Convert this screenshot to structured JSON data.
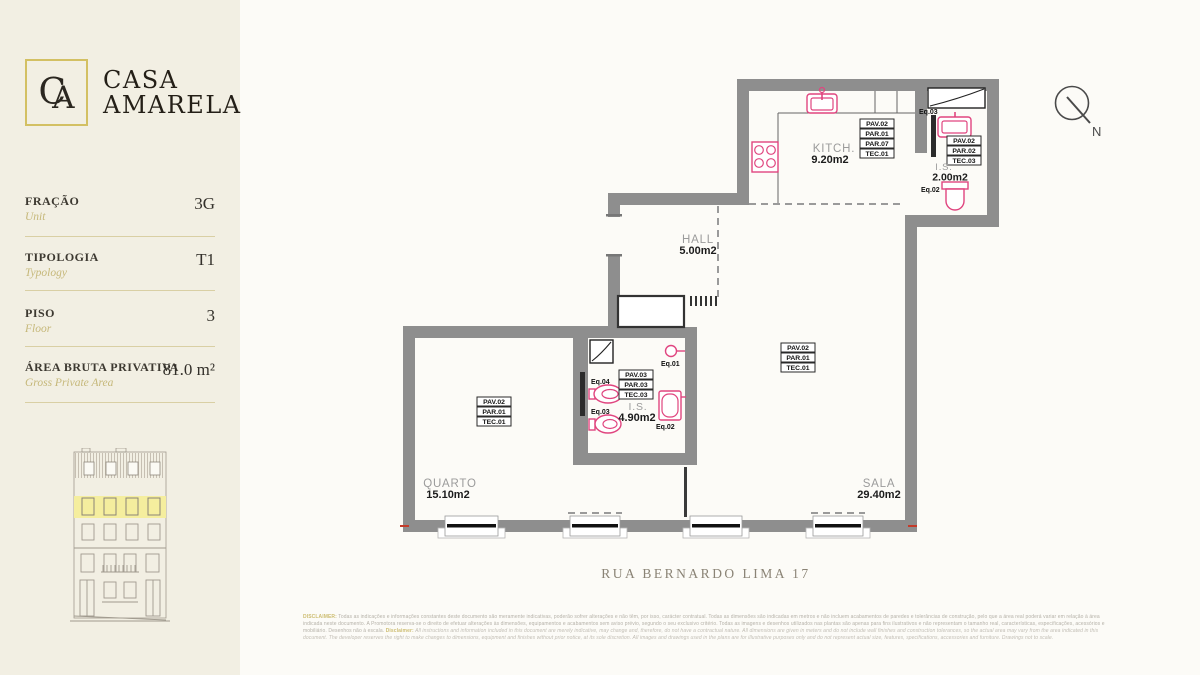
{
  "brand": {
    "monogram_c": "C",
    "monogram_a": "A",
    "line1": "CASA",
    "line2": "AMARELA"
  },
  "sidebar": {
    "fields": [
      {
        "label": "FRAÇÃO",
        "sublabel": "Unit",
        "value": "3G"
      },
      {
        "label": "TIPOLOGIA",
        "sublabel": "Typology",
        "value": "T1"
      },
      {
        "label": "PISO",
        "sublabel": "Floor",
        "value": "3"
      },
      {
        "label": "ÁREA BRUTA PRIVATIVA",
        "sublabel": "Gross Private Area",
        "value": "81.0 m²"
      }
    ]
  },
  "plan": {
    "address": "RUA BERNARDO LIMA 17",
    "compass": "N",
    "rooms": {
      "kitchen": {
        "name": "KITCH.",
        "area": "9.20m2",
        "finishes": [
          "PAV.02",
          "PAR.01",
          "PAR.07",
          "TEC.01"
        ]
      },
      "wc_small": {
        "name": "I.S.",
        "area": "2.00m2",
        "finishes": [
          "PAV.02",
          "PAR.02",
          "TEC.03"
        ],
        "eq_sink": "Eq.03",
        "eq_toilet": "Eq.02"
      },
      "hall": {
        "name": "HALL",
        "area": "5.00m2"
      },
      "bathroom": {
        "name": "I.S.",
        "area": "4.90m2",
        "finishes": [
          "PAV.03",
          "PAR.03",
          "TEC.03"
        ],
        "eq_light": "Eq.01",
        "eq_bathtub": "Eq.02",
        "eq_toilet": "Eq.03",
        "eq_bidet": "Eq.04"
      },
      "bedroom": {
        "name": "QUARTO",
        "area": "15.10m2",
        "finishes": [
          "PAV.02",
          "PAR.01",
          "TEC.01"
        ]
      },
      "living": {
        "name": "SALA",
        "area": "29.40m2",
        "finishes": [
          "PAV.02",
          "PAR.01",
          "TEC.01"
        ]
      }
    }
  },
  "disclaimer": {
    "l1_lead": "DISCLAIMER:",
    "l1_text": " Todas as indicações e informações constantes deste documento são meramente indicativas, poderão sofrer alterações e não têm, por isso, carácter contratual. Todas as dimensões são indicadas em metros e não incluem acabamentos de paredes e tolerâncias de construção, pelo que a área real poderá variar em relação à área",
    "l2_text": "indicada neste documento. A Promotora reserva-se o direito de efetuar alterações às dimensões, equipamentos e acabamentos sem aviso prévio, segundo o seu exclusivo critério. Todas as imagens e desenhos utilizados nas plantas são apenas para fins ilustrativos e não representam o tamanho real, características, especificações, acessórios e",
    "l3_pre": "mobiliário. Desenhos não à escala. ",
    "l3_lead": "Disclaimer:",
    "l3_text": " All instructions and information included in this document are merely indicative, may change and, therefore, do not have a contractual nature. All dimensions are given in meters and do not include wall finishes and construction tolerances, so the actual area may vary from the area indicated in this",
    "l4_text": "document. The developer reserves the right to make changes to dimensions, equipment and finishes without prior notice, at its sole discretion. All images and drawings used in the plans are for illustrative purposes only and do not represent actual size, features, specifications, accessories and furniture. Drawings not to scale."
  },
  "colors": {
    "accent_gold": "#d3c063",
    "wall_gray": "#8e8e8e",
    "fixture_pink": "#e0457f",
    "floor_highlight": "#f5ee9e",
    "sidebar_cream": "#f2efe3"
  }
}
